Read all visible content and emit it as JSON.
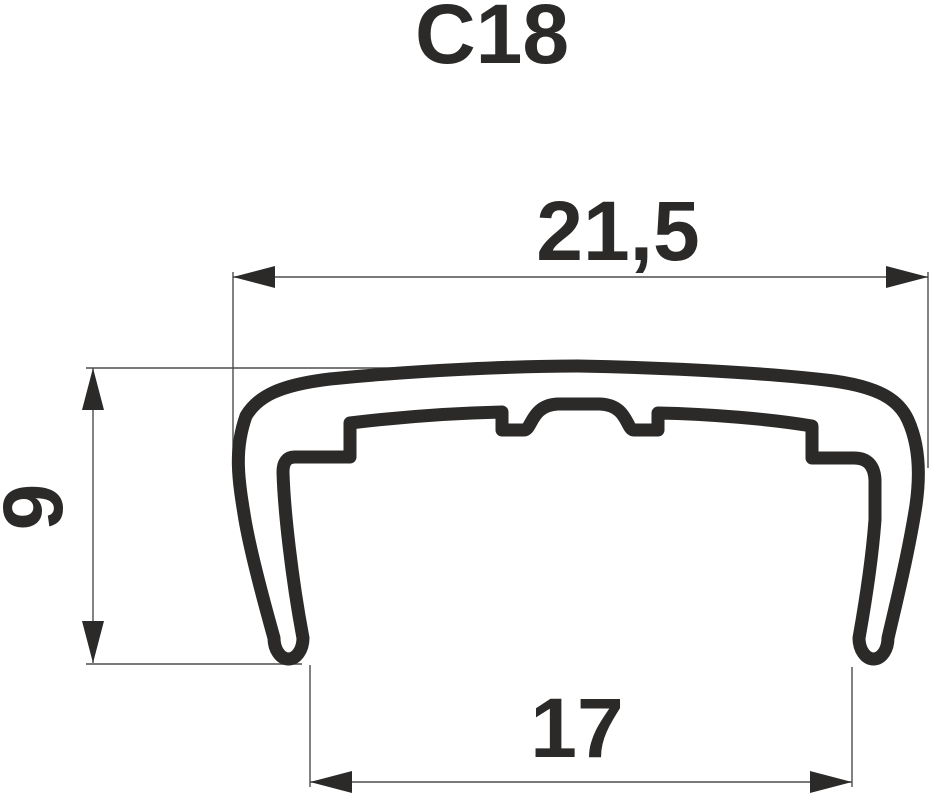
{
  "title": "C18",
  "drawing": {
    "type": "profile-cross-section",
    "dimensions": {
      "top_width": "21,5",
      "left_height": "9",
      "bottom_width": "17"
    }
  },
  "colors": {
    "outline": "#2b2a29",
    "dimension_line": "#4d4d4d",
    "text": "#2b2a29",
    "background": "#ffffff"
  }
}
